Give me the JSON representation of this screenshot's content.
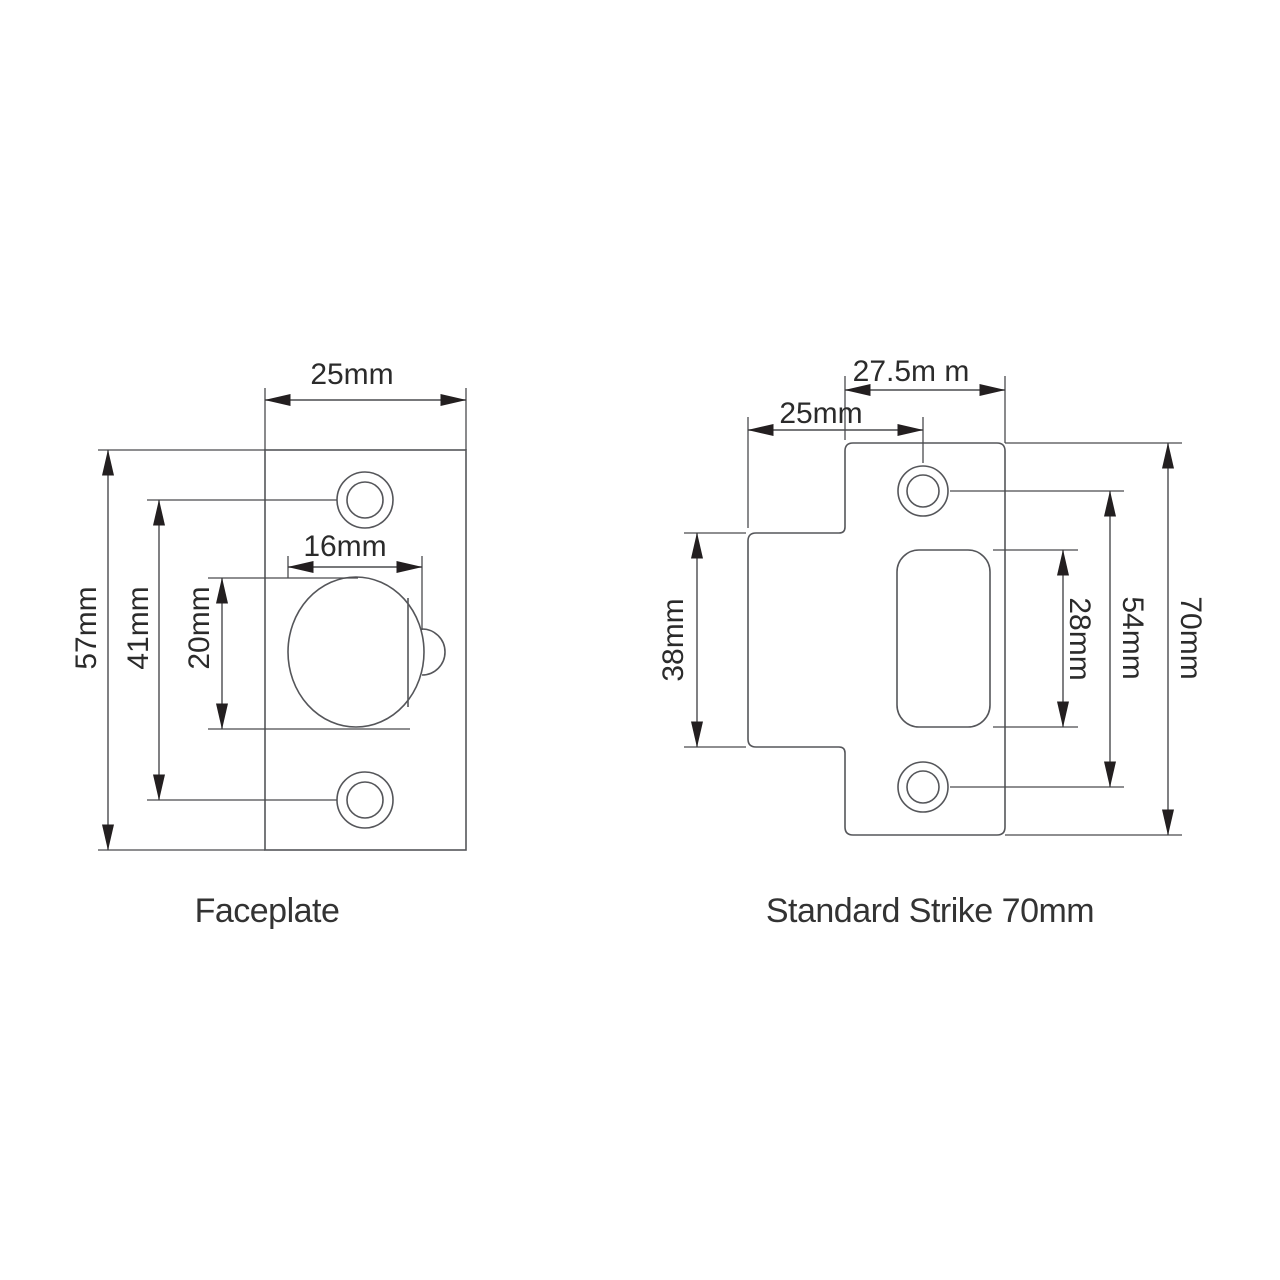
{
  "background_color": "#ffffff",
  "line_color": "#55565a",
  "dimension_line_color": "#4a4b4e",
  "arrow_color": "#231f20",
  "text_color": "#2b2b2b",
  "faceplate": {
    "title": "Faceplate",
    "dimensions": {
      "plate_width": "25mm",
      "plate_height": "57mm",
      "screw_hole_spacing": "41mm",
      "latch_height": "20mm",
      "latch_width": "16mm"
    }
  },
  "strike": {
    "title": "Standard Strike 70mm",
    "dimensions": {
      "plate_width": "27.5m m",
      "lip_edge_to_screw_centre": "25mm",
      "lip_height": "38mm",
      "cutout_height": "28mm",
      "screw_hole_spacing": "54mm",
      "plate_height": "70mm"
    }
  }
}
